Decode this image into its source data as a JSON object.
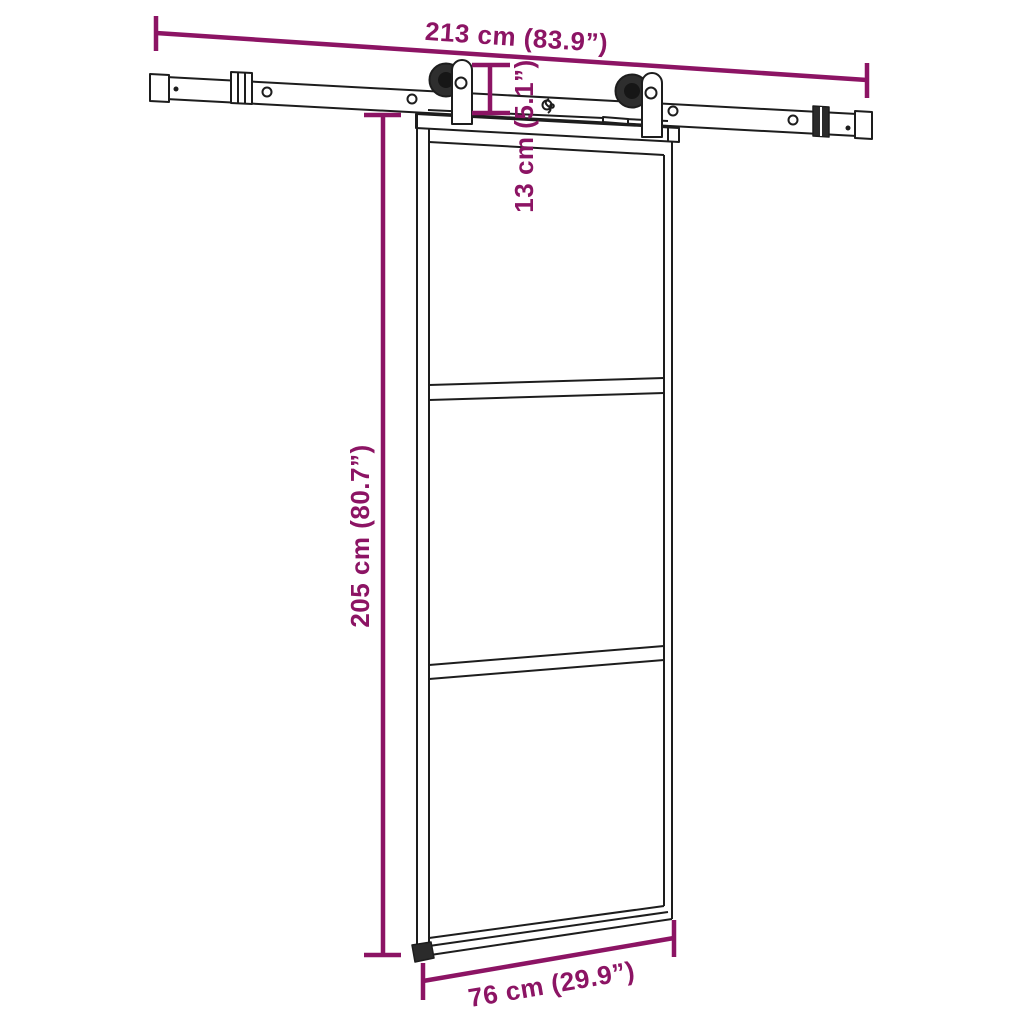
{
  "diagram": {
    "subject": "sliding-door-with-rail-hardware-dimension-drawing",
    "colors": {
      "dimension_annotation": "#8C1464",
      "line_art": "#1D1D1D",
      "background": "#FFFFFF"
    },
    "dimensions": {
      "rail_width": {
        "label": "213 cm (83.9”)",
        "cm": "213",
        "inches": "83.9"
      },
      "hanger_drop": {
        "label": "13 cm (5.1”)",
        "cm": "13",
        "inches": "5.1"
      },
      "door_height": {
        "label": "205 cm (80.7”)",
        "cm": "205",
        "inches": "80.7"
      },
      "door_width": {
        "label": "76 cm (29.9”)",
        "cm": "76",
        "inches": "29.9"
      }
    }
  }
}
